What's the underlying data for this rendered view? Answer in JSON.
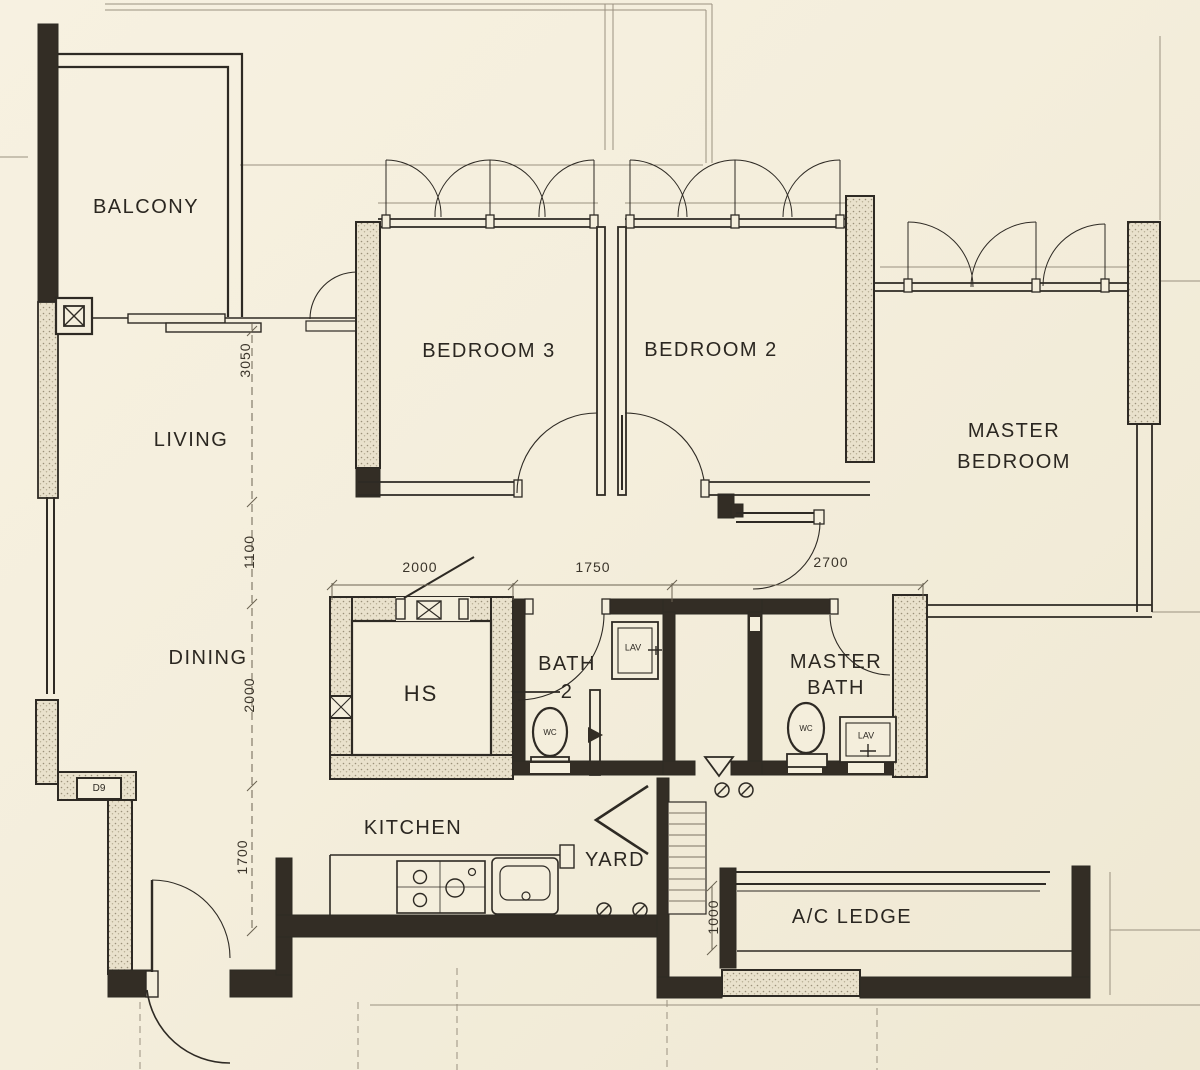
{
  "colors": {
    "paper": "#f4eedc",
    "ink": "#2e2a24",
    "faint": "#9a9180"
  },
  "rooms": {
    "balcony": "BALCONY",
    "living": "LIVING",
    "dining": "DINING",
    "bedroom3": "BEDROOM 3",
    "bedroom2": "BEDROOM 2",
    "master_bedroom": {
      "line1": "MASTER",
      "line2": "BEDROOM"
    },
    "bath2": {
      "line1": "BATH",
      "line2": "2"
    },
    "master_bath": {
      "line1": "MASTER",
      "line2": "BATH"
    },
    "hs": "HS",
    "kitchen": "KITCHEN",
    "yard": "YARD",
    "ac_ledge": "A/C LEDGE"
  },
  "fixtures": {
    "wc": "WC",
    "lav": "LAV"
  },
  "door_tag": "D9",
  "dims": {
    "vertical": [
      "3050",
      "1100",
      "2000",
      "1700"
    ],
    "horizontal": [
      "2000",
      "1750",
      "2700"
    ],
    "ac_ledge": "1000"
  }
}
